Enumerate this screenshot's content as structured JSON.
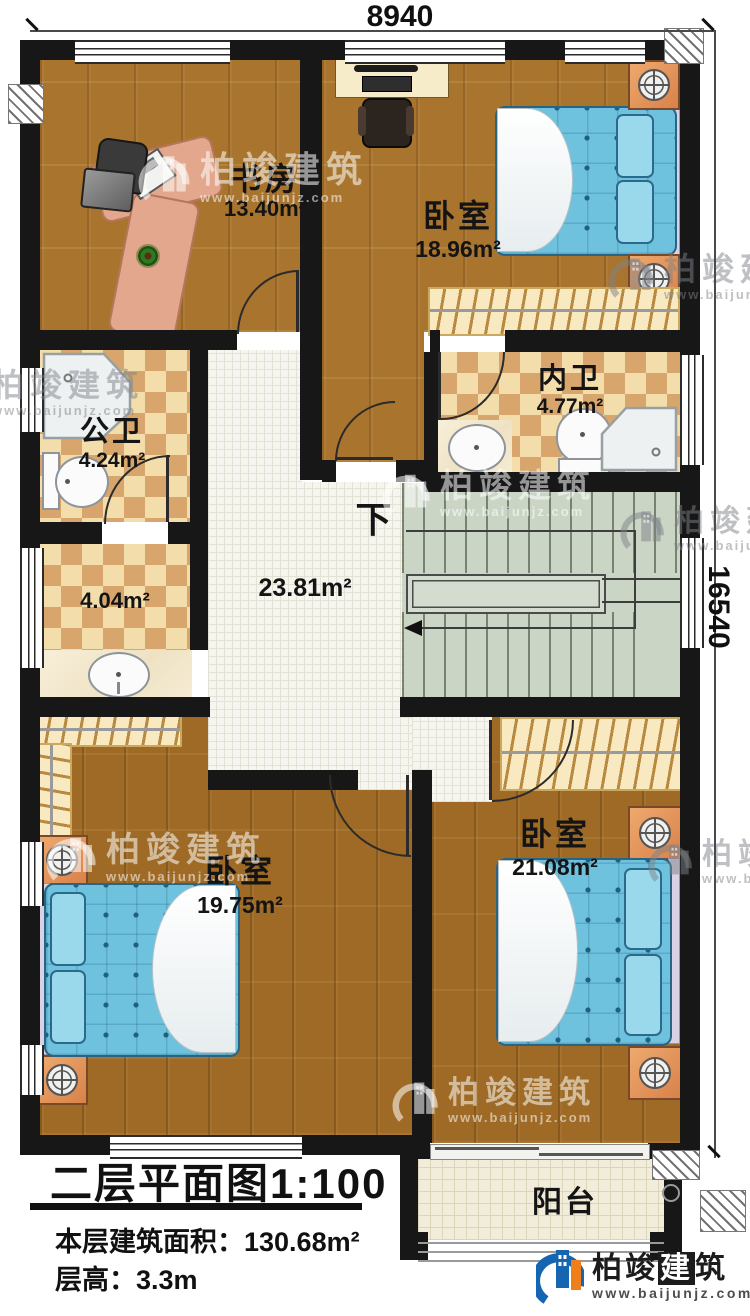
{
  "dimensions": {
    "top_width": "8940",
    "right_height": "16540"
  },
  "rooms": {
    "study": {
      "name": "书房",
      "area": "13.40m²"
    },
    "bedroom_top": {
      "name": "卧室",
      "area": "18.96m²"
    },
    "bath_inner": {
      "name": "内卫",
      "area": "4.77m²"
    },
    "bath_public": {
      "name": "公卫",
      "area": "4.24m²"
    },
    "closet": {
      "area": "4.04m²"
    },
    "hall": {
      "area": "23.81m²"
    },
    "bedroom_left": {
      "name": "卧室",
      "area": "19.75m²"
    },
    "bedroom_right": {
      "name": "卧室",
      "area": "21.08m²"
    },
    "balcony": {
      "name": "阳台"
    }
  },
  "stairs": {
    "down_label": "下"
  },
  "title_block": {
    "plan_title": "二层平面图",
    "scale": "1:100",
    "area_label": "本层建筑面积：",
    "area_value": "130.68m²",
    "height_label": "层高：",
    "height_value": "3.3m"
  },
  "watermark": {
    "brand": "柏竣建筑",
    "url": "www.baijunjz.com"
  },
  "logo": {
    "brand_a": "柏竣",
    "brand_b": "建",
    "brand_c": "筑",
    "url": "www.baijunjz.com"
  },
  "colors": {
    "wall": "#171717",
    "wood": "#a9752e",
    "checker_dark": "#d8a66c",
    "checker_light": "#f3ddab",
    "bed_blue": "#6fc2de",
    "stair_green": "#cbd5c6",
    "logo_blue": "#1565b0",
    "logo_orange": "#ef7f1b"
  }
}
